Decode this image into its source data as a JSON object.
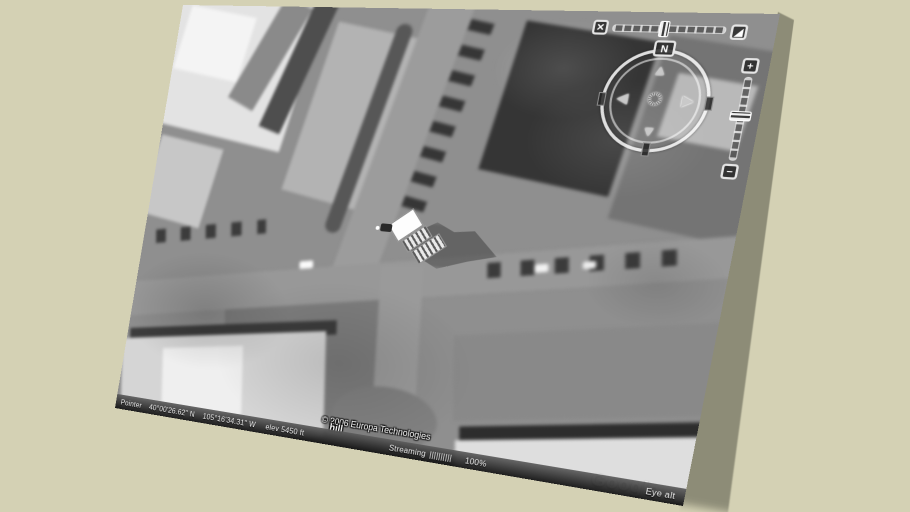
{
  "colors": {
    "background": "#d4d1b4",
    "ground_shadow": "#8d8c77",
    "status_bar_text": "#f2f2f2"
  },
  "earth_view": {
    "copyright": "© 2006 Europa Technologies",
    "placemark_label": "hill",
    "watermark": "Google",
    "status_bar": {
      "pointer_label": "Pointer",
      "latitude": "40°00'26.62\" N",
      "longitude": "105°16'34.31\" W",
      "elevation": "elev 5450 ft",
      "streaming_label": "Streaming",
      "streaming_bars": "||||||||||",
      "streaming_percent": "100%",
      "eye_alt_fragment": "Eye alt"
    },
    "navigation": {
      "north_label": "N",
      "zoom_in": "+",
      "zoom_out": "−",
      "pan_up": "▲",
      "pan_down": "▼",
      "pan_left": "◀",
      "pan_right": "▶",
      "look_knob": "✺",
      "tilt_top_down": "✕",
      "tilt_horizon": "◢"
    }
  }
}
